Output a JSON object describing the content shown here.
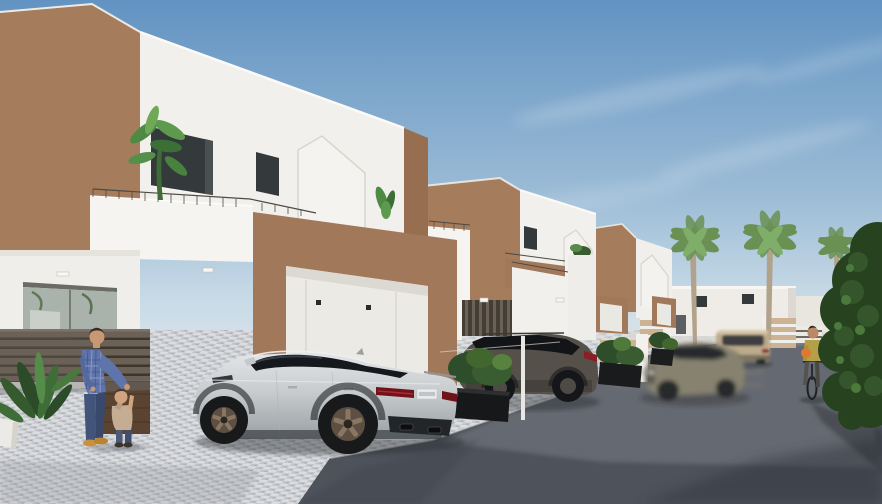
{
  "scene": {
    "type": "architectural-3d-render",
    "description": "Sunny street of new-build two-storey white villas with brown accent walls, balconies and garages; silver sports sedan and dark SUV parked on cobbled driveways, a blurred grey sedan and beige SUV on the asphalt road, palm trees, a man playing with a toddler and a woman cycling towards the viewer."
  },
  "palette": {
    "sky_top": "#6293c2",
    "sky_horizon": "#d8e3eb",
    "facade_white": "#f2f0ec",
    "recess_white": "#eceae4",
    "wall_brown": "#a57c5c",
    "wall_brown_dark": "#986e50",
    "garage_brown": "#a2785a",
    "beige_gate": "#cbb393",
    "cobble_light": "#d9dadc",
    "cobble_mid": "#c2c5c9",
    "asphalt": "#4d525b",
    "asphalt_light": "#73777e",
    "hedge_green": "#26421f",
    "palm_green": "#6a9054",
    "palm_trunk": "#b1a28b",
    "shrub_green": "#3a5c31",
    "audi_silver": "#c7cbcd",
    "suv_gray": "#55504a",
    "sedan_taupe": "#8b8678",
    "suv_beige": "#bcab8b",
    "fence_wood": "#6b6156",
    "gate_wood": "#5a4431",
    "shirt_blue": "#5f74aa",
    "jeans_blue": "#42547a",
    "jacket_yellow": "#b5a04a",
    "bag_orange": "#de7a2e",
    "tail_red": "#8c1d22",
    "window_dark": "#34393c",
    "glass_dark": "#15181c"
  },
  "objects": {
    "scene_root": {
      "label": "3D render of a residential street with white and brown villas"
    },
    "sky": {
      "label": "clear blue sky with thin wispy clouds"
    },
    "street": {
      "label": "cobbled driveways and asphalt road"
    },
    "house1": {
      "label": "foreground two-storey villa with brown side wall, balcony, plant and garage"
    },
    "house2": {
      "label": "second villa with brown accent wall and carport"
    },
    "house3": {
      "label": "third villa modules with garages and striped gate wall"
    },
    "background_buildings": {
      "label": "distant white two-storey houses and entrance gates"
    },
    "palm_trees": {
      "label": "tall palm trees along the street"
    },
    "audi": {
      "label": "silver Audi sportback parked on driveway, rear three-quarter view"
    },
    "mazda_suv": {
      "label": "dark grey SUV parked on next driveway"
    },
    "blurred_sedan": {
      "label": "grey sedan driving past with motion blur"
    },
    "beige_suv": {
      "label": "beige SUV further down the road"
    },
    "man": {
      "label": "man in blue checked shirt playing with a toddler"
    },
    "child": {
      "label": "toddler holding the man's hand"
    },
    "cyclist": {
      "label": "woman in yellow jacket riding a bicycle"
    },
    "fence": {
      "label": "horizontal slat fence"
    },
    "gate": {
      "label": "dark wooden entrance gate"
    },
    "left_plant": {
      "label": "potted green plant in the left corner"
    },
    "hedge": {
      "label": "dense leafy green tree at the right edge"
    },
    "planters": {
      "label": "black planter boxes with shrubs between driveways"
    },
    "wire_fence": {
      "label": "light fence post in front of the SUV"
    }
  }
}
